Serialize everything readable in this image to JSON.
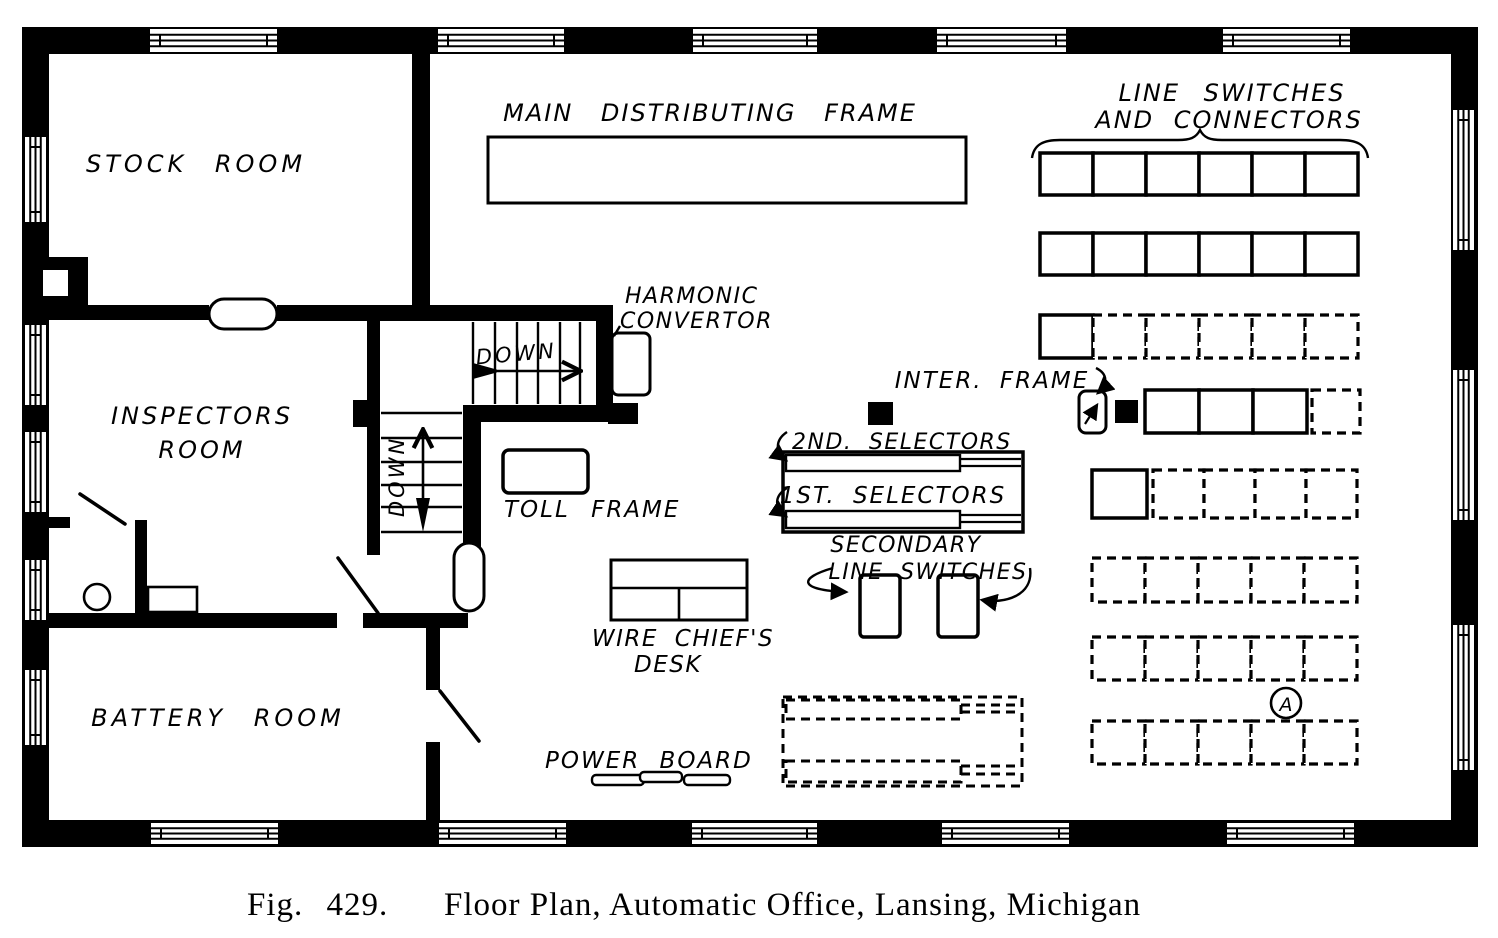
{
  "figure": {
    "fig_label": "Fig. 429.",
    "caption": "Floor Plan, Automatic Office, Lansing, Michigan"
  },
  "rooms": {
    "stock": "STOCK ROOM",
    "inspectors_1": "INSPECTORS",
    "inspectors_2": "ROOM",
    "battery": "BATTERY ROOM"
  },
  "labels": {
    "mdf": "MAIN DISTRIBUTING FRAME",
    "line_switches_1": "LINE SWITCHES",
    "line_switches_2": "AND CONNECTORS",
    "harmonic_1": "HARMONIC",
    "harmonic_2": "CONVERTOR",
    "inter_frame": "INTER. FRAME",
    "second_selectors": "2ND. SELECTORS",
    "first_selectors": "1ST. SELECTORS",
    "secondary_1": "SECONDARY",
    "secondary_2": "LINE SWITCHES",
    "toll_frame": "TOLL FRAME",
    "wire_chiefs_1": "WIRE CHIEF'S",
    "wire_chiefs_2": "DESK",
    "power_board": "POWER BOARD"
  },
  "stairs": {
    "down_upper": "DOWN",
    "down_lower": "DOWN"
  },
  "markers": {
    "a": "A"
  },
  "colors": {
    "ink": "#000000",
    "paper": "#ffffff"
  },
  "line_switch_grid": {
    "rows": [
      {
        "y": 153,
        "h": 42,
        "segments": [
          {
            "x": 1040,
            "cell_w": 53,
            "count": 6,
            "style": "solid"
          }
        ]
      },
      {
        "y": 233,
        "h": 42,
        "segments": [
          {
            "x": 1040,
            "cell_w": 53,
            "count": 6,
            "style": "solid"
          }
        ]
      },
      {
        "y": 315,
        "h": 43,
        "segments": [
          {
            "x": 1040,
            "cell_w": 53,
            "count": 1,
            "style": "solid"
          },
          {
            "x": 1093,
            "cell_w": 53,
            "count": 5,
            "style": "dashed"
          }
        ]
      },
      {
        "y": 390,
        "h": 43,
        "segments": [
          {
            "x": 1145,
            "cell_w": 54,
            "count": 3,
            "style": "solid"
          },
          {
            "x": 1312,
            "cell_w": 48,
            "count": 1,
            "style": "dashed"
          }
        ]
      },
      {
        "y": 470,
        "h": 48,
        "segments": [
          {
            "x": 1092,
            "cell_w": 55,
            "count": 1,
            "style": "solid"
          },
          {
            "x": 1153,
            "cell_w": 51,
            "count": 4,
            "style": "dashed"
          }
        ]
      },
      {
        "y": 558,
        "h": 44,
        "segments": [
          {
            "x": 1092,
            "cell_w": 53,
            "count": 5,
            "style": "dashed"
          }
        ]
      },
      {
        "y": 637,
        "h": 43,
        "segments": [
          {
            "x": 1092,
            "cell_w": 53,
            "count": 5,
            "style": "dashed"
          }
        ]
      },
      {
        "y": 721,
        "h": 43,
        "segments": [
          {
            "x": 1092,
            "cell_w": 53,
            "count": 5,
            "style": "dashed"
          }
        ]
      }
    ]
  }
}
